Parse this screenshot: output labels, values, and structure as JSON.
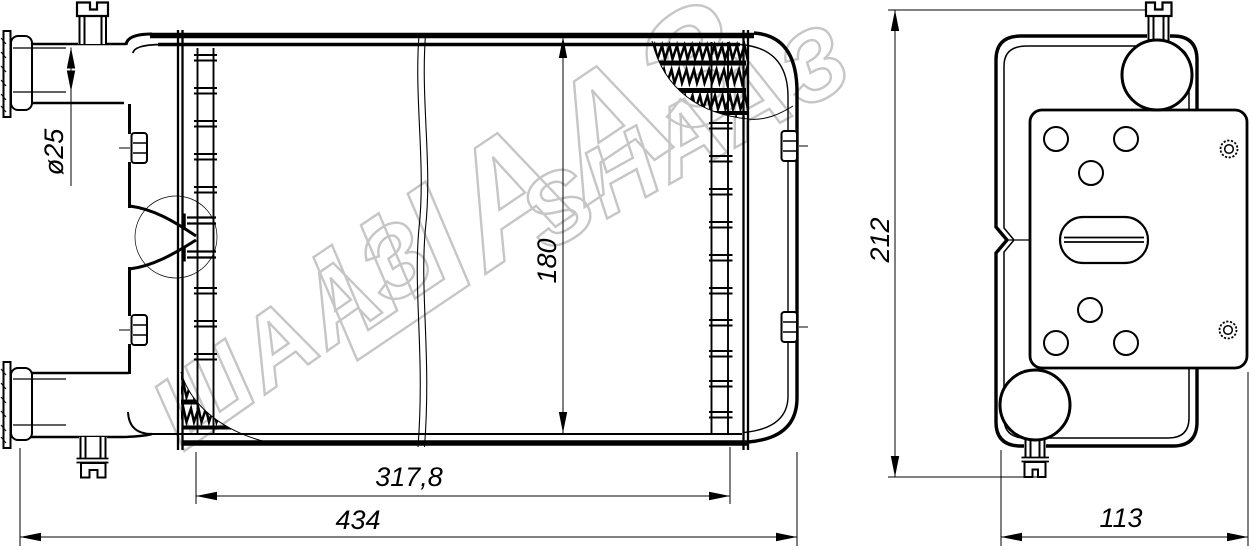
{
  "watermark": {
    "color": "#c6c6c6",
    "parts": [
      {
        "text": "ШААЗ"
      },
      {
        "text": "ШААЗ"
      },
      {
        "text": "SHAAЗ"
      }
    ]
  },
  "dimensions": {
    "pipe_diameter": "ø25",
    "core_height": "180",
    "core_width": "317,8",
    "overall_width": "434",
    "side_height": "212",
    "side_depth": "113"
  },
  "colors": {
    "line": "#000000",
    "background": "#ffffff",
    "watermark": "#c6c6c6"
  }
}
